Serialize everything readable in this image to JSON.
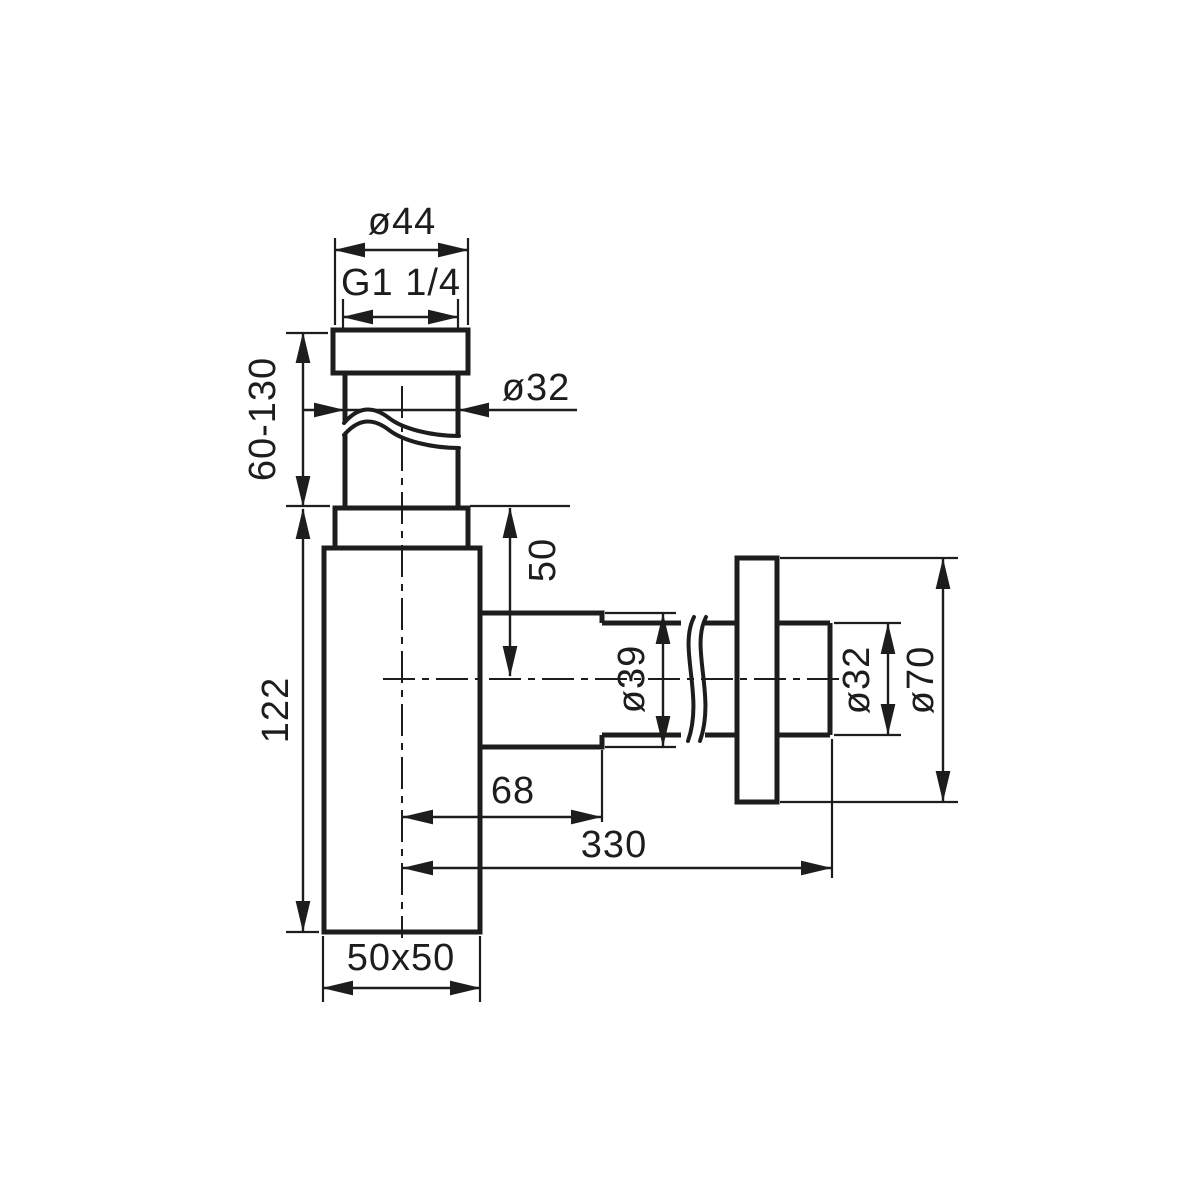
{
  "page": {
    "background": "#ffffff",
    "stroke_color": "#1d1d1b"
  },
  "drawing": {
    "kind": "technical dimension drawing of a bottle trap siphon",
    "labels": {
      "inlet_nut_diameter": "ø44",
      "thread_size": "G1 1/4",
      "inlet_pipe_diameter": "ø32",
      "inlet_height_range": "60-130",
      "body_height": "122",
      "outlet_center_offset": "50",
      "outlet_nut_diameter": "ø39",
      "outlet_pipe_diameter": "ø32",
      "rosette_diameter": "ø70",
      "outlet_stub_length": "68",
      "outlet_total_length": "330",
      "body_footprint": "50x50"
    }
  }
}
